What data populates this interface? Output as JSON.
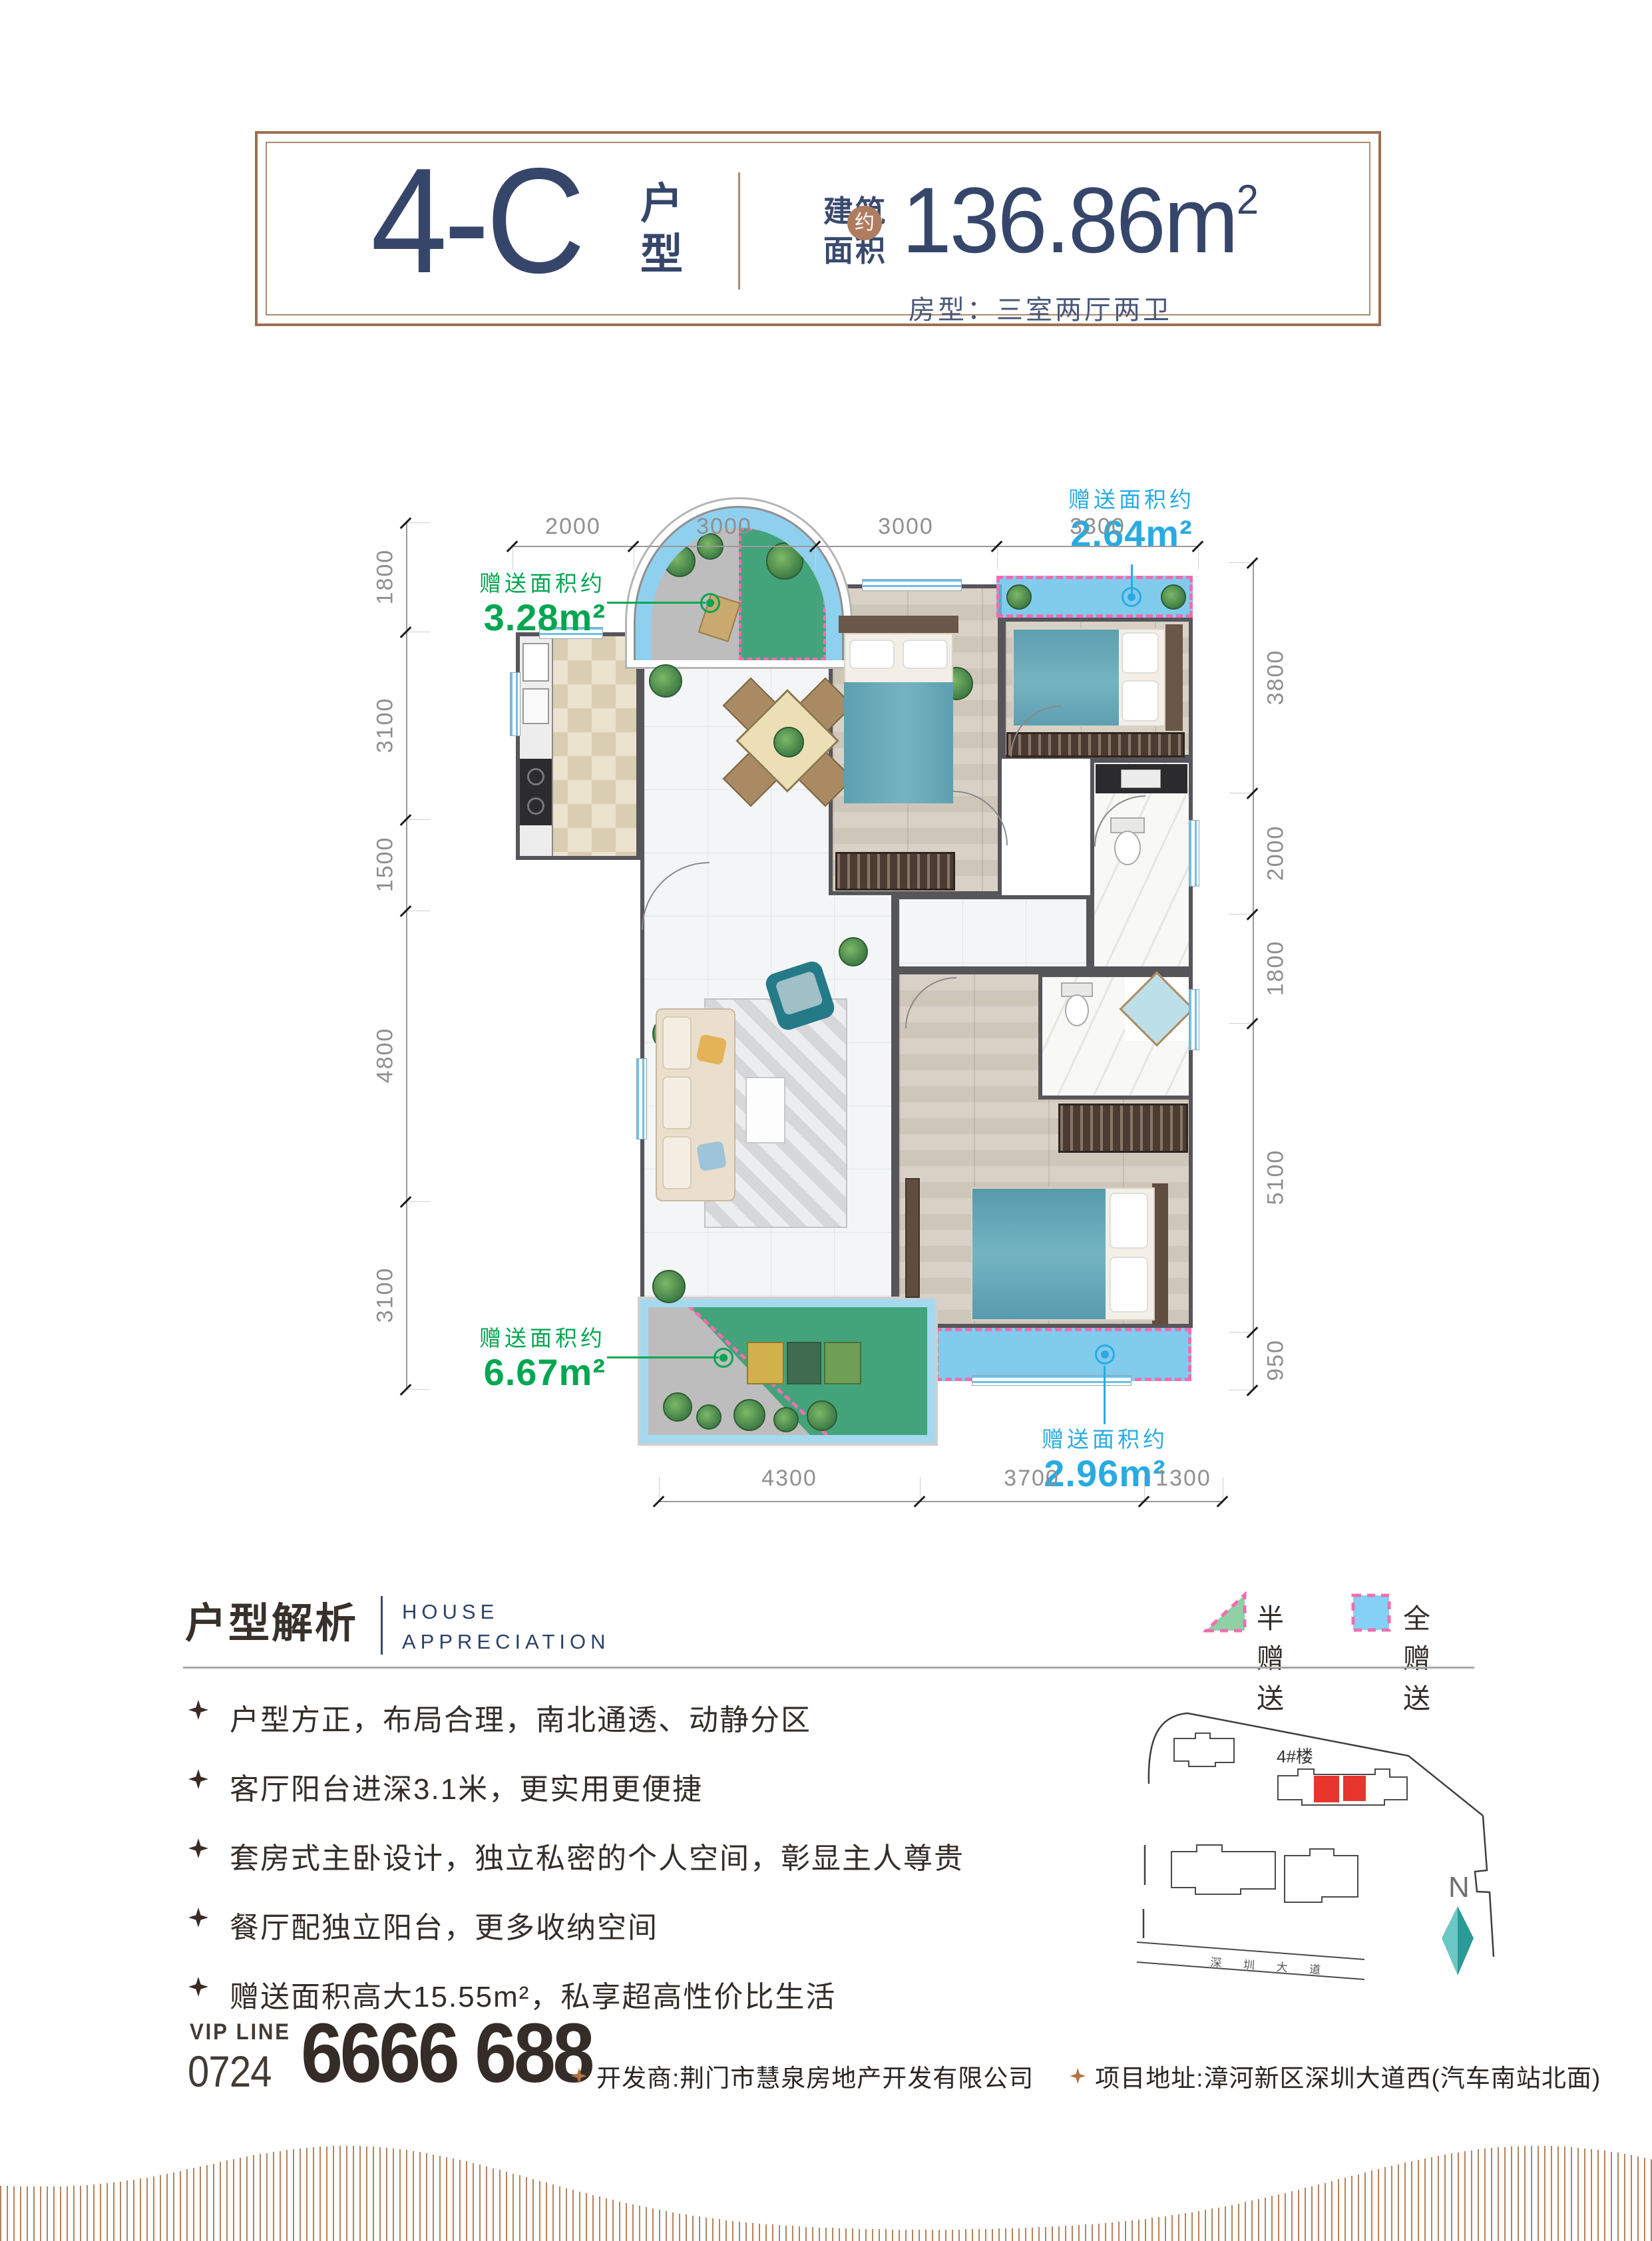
{
  "header": {
    "unit": "4-C",
    "unit_suffix": "户型",
    "area_label_top": "建筑",
    "area_label_bottom": "面积",
    "area_approx": "约",
    "area_value": "136.86m",
    "area_sup": "2",
    "room_type": "房型：三室两厅两卫"
  },
  "plan": {
    "dims_top": [
      "2000",
      "3000",
      "3000",
      "3300"
    ],
    "dims_bottom": [
      "4300",
      "3700",
      "1300"
    ],
    "dims_left": [
      "1800",
      "3100",
      "1500",
      "4800",
      "3100"
    ],
    "dims_right": [
      "3800",
      "2000",
      "1800",
      "5100",
      "950"
    ],
    "gifts": {
      "g1": {
        "label": "赠送面积约",
        "value": "3.28m²"
      },
      "g2": {
        "label": "赠送面积约",
        "value": "2.64m²"
      },
      "g3": {
        "label": "赠送面积约",
        "value": "6.67m²"
      },
      "g4": {
        "label": "赠送面积约",
        "value": "2.96m²"
      }
    }
  },
  "analysis": {
    "title": "户型解析",
    "subtitle_line1": "HOUSE",
    "subtitle_line2": "APPRECIATION",
    "legend_half": "半赠送",
    "legend_full": "全赠送",
    "bullets": [
      "户型方正，布局合理，南北通透、动静分区",
      "客厅阳台进深3.1米，更实用更便捷",
      "套房式主卧设计，独立私密的个人空间，彰显主人尊贵",
      "餐厅配独立阳台，更多收纳空间",
      "赠送面积高大15.55m²，私享超高性价比生活"
    ]
  },
  "sitemap": {
    "building_label": "4#楼",
    "road_label": "深 圳 大 道",
    "compass_label": "N"
  },
  "footer": {
    "vip_label": "VIP LINE",
    "vip_code": "0724",
    "vip_number": "6666 688",
    "developer": "开发商:荆门市慧泉房地产开发有限公司",
    "address": "项目地址:漳河新区深圳大道西(汽车南站北面)"
  },
  "colors": {
    "navy": "#36466b",
    "copper_frame": "#9c6f52",
    "badge_copper": "#b07c5f",
    "gift_green": "#00a651",
    "gift_blue": "#29abe2",
    "dash_pink": "#f06eb0",
    "legend_green": "#8fd0a5",
    "legend_blue": "#85d1f5",
    "highlight_red": "#e8362d",
    "wave_copper": "#b5835f"
  }
}
